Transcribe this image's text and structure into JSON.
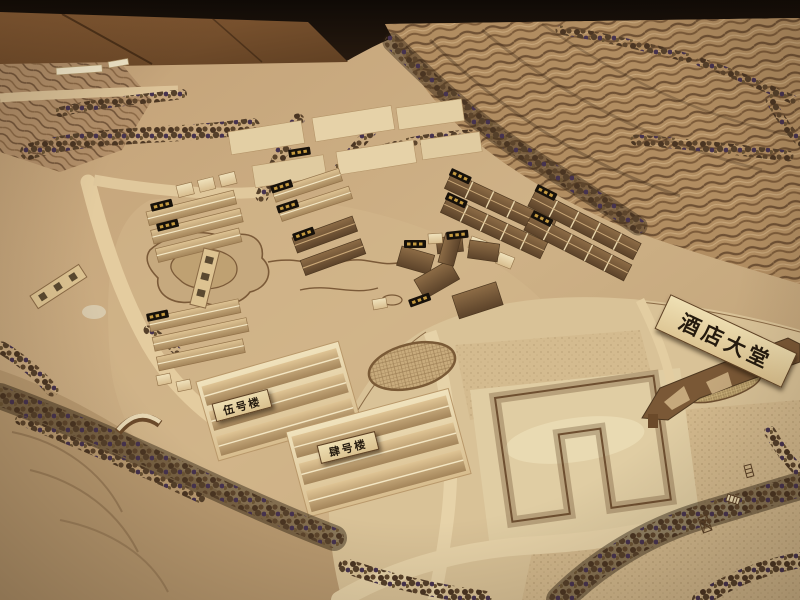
{
  "photo": {
    "signs": {
      "hotel_lobby": "酒店大堂",
      "building_no5": "伍号楼",
      "building_no4": "肆号楼"
    },
    "palette": {
      "background_wall": "#1d130c",
      "wood_floor": "#7b5530",
      "terrain": "#c5a87e",
      "terrain_light": "#dcc79c",
      "terrace_stripe": "#6f5134",
      "building_cream": "#e8d4a8",
      "roof_dark": "#6f5134",
      "trees": "#4a3522",
      "plaque_black": "#17110a",
      "plaque_gold": "#c59a3f",
      "sign_board": "#e2c996",
      "sign_text": "#241a0e"
    }
  }
}
